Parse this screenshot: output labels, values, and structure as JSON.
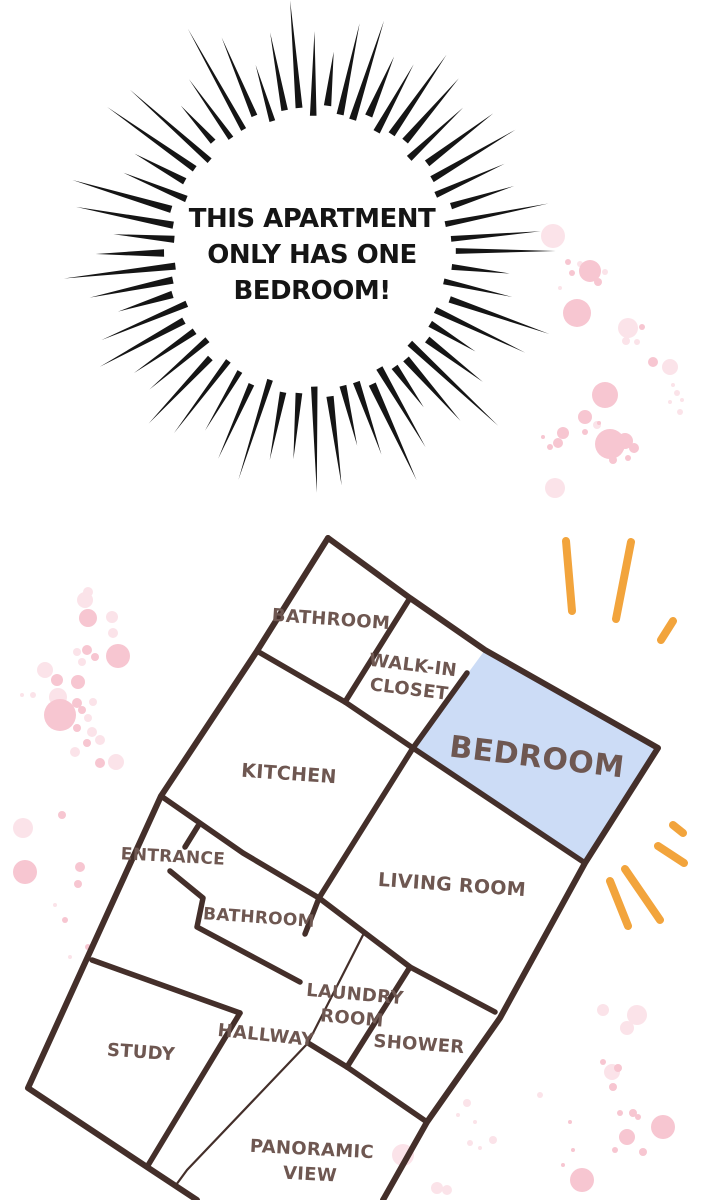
{
  "scene": {
    "burst": {
      "lines": [
        "THIS APARTMENT",
        "ONLY HAS ONE",
        "BEDROOM!"
      ]
    },
    "floor_plan": {
      "highlighted_room": "BEDROOM",
      "rooms": {
        "bathroom_top": "BATHROOM",
        "walk_in_closet_line1": "WALK-IN",
        "walk_in_closet_line2": "CLOSET",
        "bedroom": "BEDROOM",
        "kitchen": "KITCHEN",
        "entrance": "ENTRANCE",
        "living_room": "LIVING ROOM",
        "bathroom_lower": "BATHROOM",
        "laundry_room_line1": "LAUNDRY",
        "laundry_room_line2": "ROOM",
        "hallway": "HALLWAY",
        "shower": "SHOWER",
        "study": "STUDY",
        "panoramic_view_line1": "PANORAMIC",
        "panoramic_view_line2": "VIEW"
      }
    },
    "colors": {
      "background": "#ffffff",
      "burst_ink": "#151515",
      "wall_brown": "#442f2a",
      "label_brown": "#6e5751",
      "bedroom_fill": "#ccdcf6",
      "accent_orange": "#f2a43c",
      "pink_strong": "#f7c6d1",
      "pink_light": "#fbe3e9"
    }
  }
}
